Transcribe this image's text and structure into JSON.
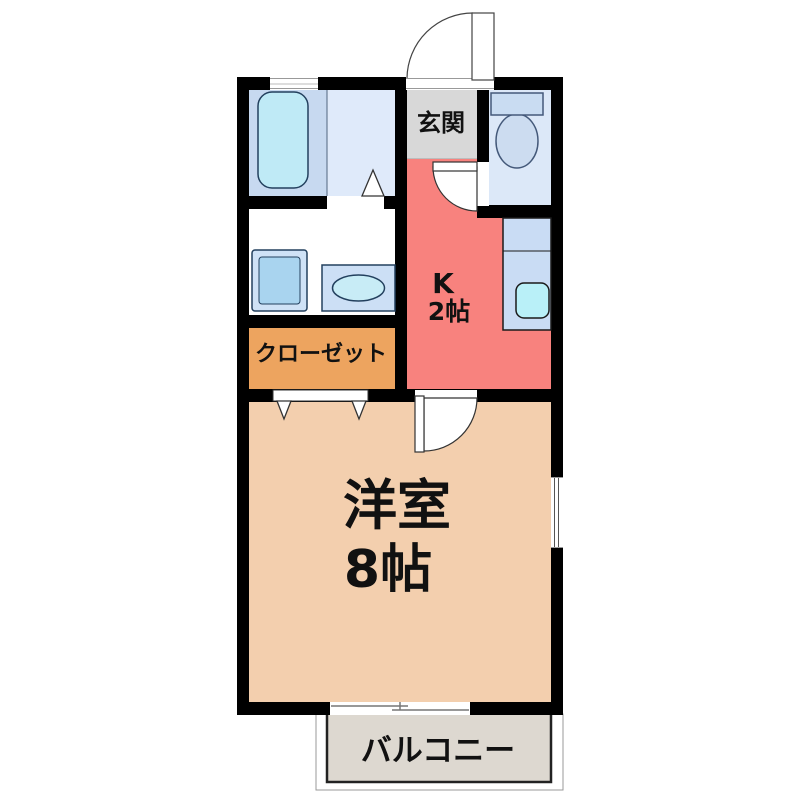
{
  "plan": {
    "type": "japanese-apartment-floor-plan",
    "rooms": {
      "entrance": {
        "label": "玄関"
      },
      "kitchen": {
        "label": "K",
        "size": "2帖"
      },
      "closet": {
        "label": "クローゼット"
      },
      "western_room": {
        "label": "洋室",
        "size": "8帖"
      },
      "balcony": {
        "label": "バルコニー"
      },
      "bathroom": {
        "label": ""
      },
      "washroom": {
        "label": ""
      },
      "toilet": {
        "label": ""
      }
    },
    "fixtures": [
      "bathtub",
      "washing-machine-pan",
      "wash-basin",
      "toilet",
      "kitchen-sink-counter"
    ],
    "symbols": [
      "entrance-door-swing",
      "toilet-door-swing",
      "room-door-swing",
      "bathroom-door-mark",
      "closet-folding-doors",
      "balcony-sliding-window",
      "side-window",
      "bathroom-window"
    ],
    "colors": {
      "wall": "#000000",
      "kitchen_floor": "#f8827e",
      "western_room_floor": "#f3cfae",
      "closet_floor": "#eda45f",
      "entrance_floor": "#d8d8d8",
      "balcony_floor": "#ddd8d0",
      "bathroom_left_floor": "#c7d9f0",
      "bathroom_right_floor": "#dfeafa",
      "toilet_floor": "#dce8f8",
      "fixture_blue": "#c9dcf4",
      "fixture_cyan": "#bfeaf6",
      "symbol_white": "#ffffff"
    }
  }
}
